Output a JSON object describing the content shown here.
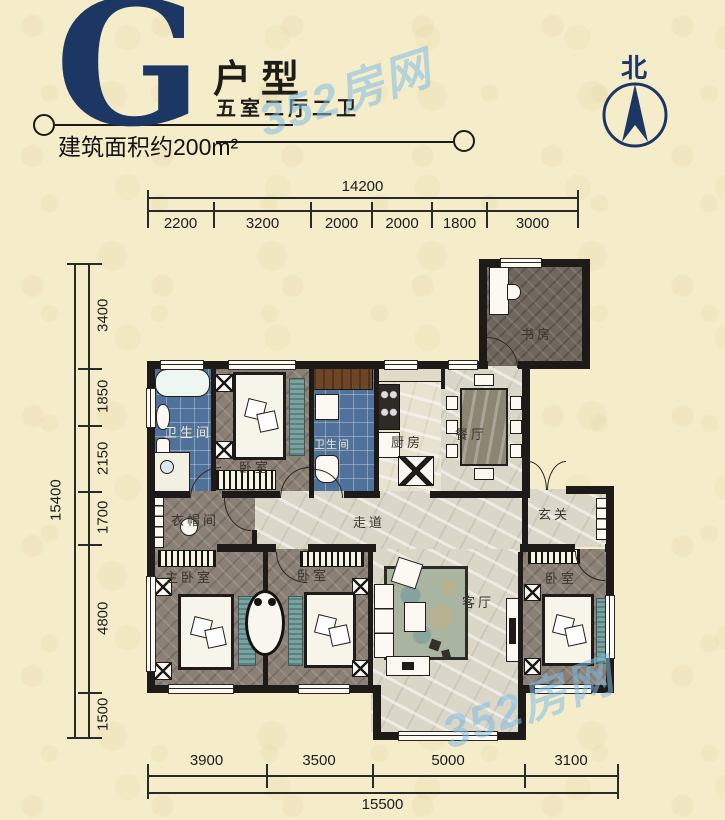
{
  "header": {
    "letter": "G",
    "type_label": "户型",
    "rooms_label": "五室二厅二卫",
    "area_label": "建筑面积约200m²"
  },
  "compass": {
    "north_label": "北"
  },
  "watermark": {
    "text": "352房网"
  },
  "dimensions": {
    "top": {
      "total": "14200",
      "segments": [
        "2200",
        "3200",
        "2000",
        "2000",
        "1800",
        "3000"
      ]
    },
    "left": {
      "total": "15400",
      "segments": [
        "3400",
        "1850",
        "2150",
        "1700",
        "4800",
        "1500"
      ]
    },
    "bottom": {
      "total": "15500",
      "segments": [
        "3900",
        "3500",
        "5000",
        "3100"
      ]
    }
  },
  "rooms": {
    "study": "书房",
    "bath1": "卫生间",
    "bedroom_top": "卧室",
    "bath2": "卫生间",
    "kitchen": "厨房",
    "dining": "餐厅",
    "cloakroom": "衣帽间",
    "corridor": "走道",
    "entry": "玄关",
    "master_bedroom": "主卧室",
    "bedroom2": "卧室",
    "living": "客厅",
    "bedroom3": "卧室"
  }
}
